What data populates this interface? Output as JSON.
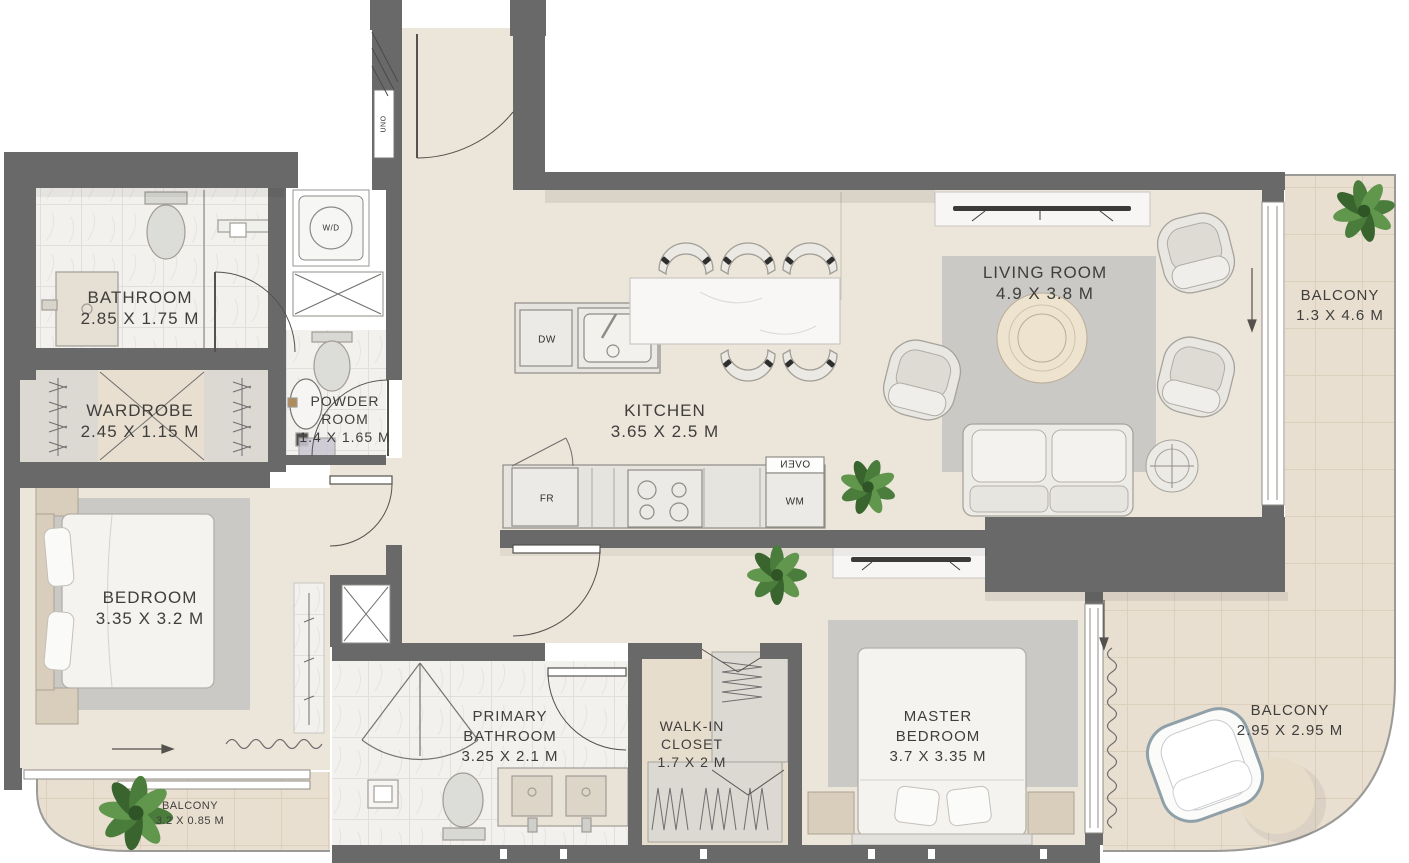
{
  "plan": {
    "rooms": {
      "bathroom": {
        "name": "BATHROOM",
        "dims": "2.85 X 1.75 M"
      },
      "wardrobe": {
        "name": "WARDROBE",
        "dims": "2.45 X 1.15 M"
      },
      "powder_room": {
        "line1": "POWDER",
        "line2": "ROOM",
        "dims": "1.4 X 1.65 M"
      },
      "kitchen": {
        "name": "KITCHEN",
        "dims": "3.65 X 2.5 M"
      },
      "living_room": {
        "name": "LIVING ROOM",
        "dims": "4.9 X 3.8 M"
      },
      "bedroom": {
        "name": "BEDROOM",
        "dims": "3.35 X 3.2 M"
      },
      "primary_bathroom": {
        "line1": "PRIMARY",
        "line2": "BATHROOM",
        "dims": "3.25 X 2.1 M"
      },
      "walk_in_closet": {
        "line1": "WALK-IN",
        "line2": "CLOSET",
        "dims": "1.7 X 2 M"
      },
      "master_bedroom": {
        "line1": "MASTER",
        "line2": "BEDROOM",
        "dims": "3.7 X 3.35 M"
      },
      "balcony_right": {
        "name": "BALCONY",
        "dims": "1.3 X 4.6 M"
      },
      "balcony_bottom_right": {
        "name": "BALCONY",
        "dims": "2.95 X 2.95 M"
      },
      "balcony_bottom_left": {
        "name": "BALCONY",
        "dims": "3.2 X 0.85 M"
      }
    },
    "appliances": {
      "washer_dryer": "W/D",
      "dishwasher": "DW",
      "fridge": "FR",
      "washing_machine": "WM",
      "oven": "OVEN",
      "utility_label": "UNO"
    },
    "colors": {
      "wall": "#696969",
      "floor": "#ece5da",
      "balcony_floor": "#e9dfd1",
      "marble": "#f2f1ee",
      "rug": "#cbc9c6",
      "accent_green": "#4a7c3b",
      "label_text": "#3f3e3c"
    }
  }
}
